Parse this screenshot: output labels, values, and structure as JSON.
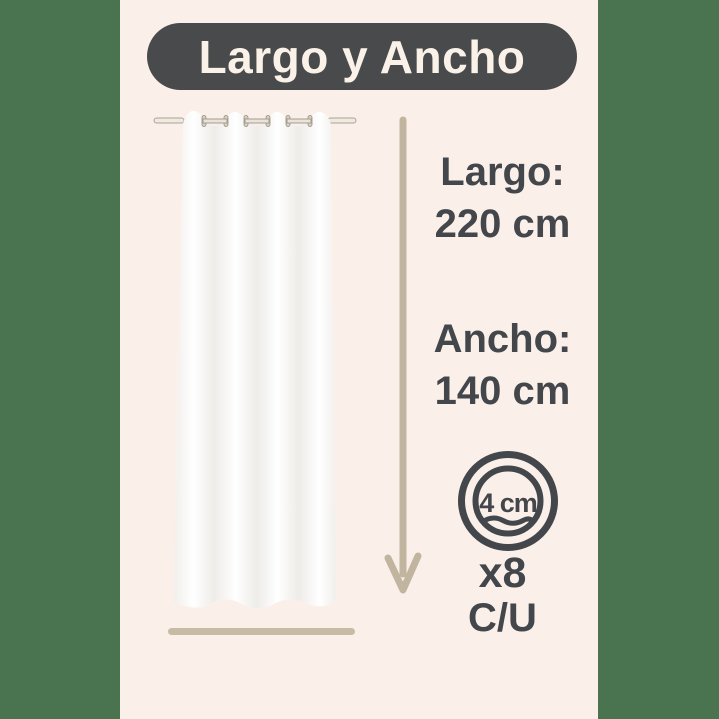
{
  "header": {
    "title": "Largo y Ancho"
  },
  "measurements": {
    "length": {
      "label": "Largo:",
      "value": "220 cm"
    },
    "width": {
      "label": "Ancho:",
      "value": "140 cm"
    }
  },
  "grommet_badge": {
    "diameter": "4 cm",
    "quantity": "x8",
    "per_unit": "C/U"
  },
  "icons": {
    "curtain": "white-grommet-curtain-illustration",
    "arrow": "down-arrow-length-indicator",
    "grommet": "grommet-ring-diameter-icon"
  },
  "colors": {
    "side_bars": "#4a7350",
    "panel_background": "#faf0e9",
    "title_pill": "#494a4b",
    "title_text": "#faf2e9",
    "text": "#43464a",
    "arrow_tan": "#c2b5a0",
    "width_line_tan": "#c7bba6"
  }
}
